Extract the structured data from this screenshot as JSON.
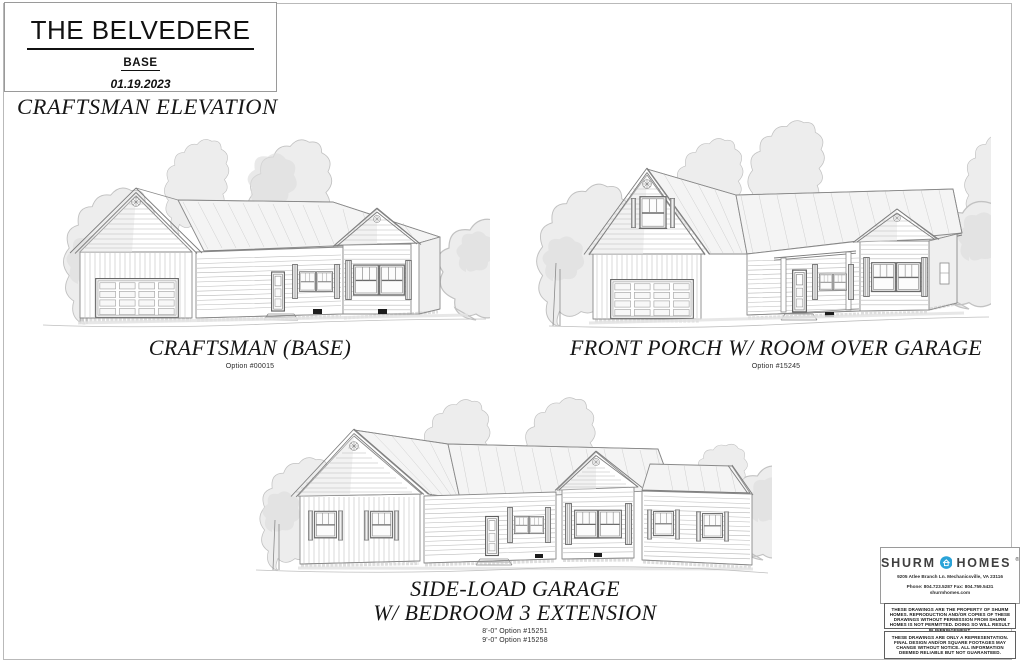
{
  "title_block": {
    "title": "THE BELVEDERE",
    "subtitle": "BASE",
    "date": "01.19.2023"
  },
  "heading": "CRAFTSMAN ELEVATION",
  "elevations": [
    {
      "caption_lines": [
        "CRAFTSMAN (BASE)"
      ],
      "options": [
        "Option #00015"
      ]
    },
    {
      "caption_lines": [
        "FRONT PORCH W/ ROOM OVER GARAGE"
      ],
      "options": [
        "Option #15245"
      ]
    },
    {
      "caption_lines": [
        "SIDE-LOAD GARAGE",
        "W/ BEDROOM 3 EXTENSION"
      ],
      "options": [
        "8'-0\" Option #15251",
        "9'-0\" Option #15258"
      ]
    }
  ],
  "brand": {
    "name_left": "SHURM",
    "name_right": "HOMES",
    "registered_mark": "®",
    "home_icon": "house-in-circle-icon",
    "logo_color": "#2aa3d8",
    "address": "9205 Atlee Branch Ln. Mechanicsville, VA 23116",
    "phone_fax": "Phone: 804.723.5287 Fax: 804.759.5431",
    "website": "shurmhomes.com"
  },
  "disclaimers": [
    "THESE DRAWINGS ARE THE PROPERTY OF SHURM HOMES. REPRODUCTION AND/OR COPIES OF THESE DRAWINGS WITHOUT PERMISSION FROM SHURM HOMES IS NOT PERMITTED. DOING SO WILL RESULT IN INFRINGEMENT.",
    "THESE DRAWINGS ARE ONLY A REPRESENTATION. FINAL DESIGN AND/OR SQUARE FOOTAGES MAY CHANGE WITHOUT NOTICE. ALL INFORMATION DEEMED RELIABLE BUT NOT GUARANTEED."
  ]
}
